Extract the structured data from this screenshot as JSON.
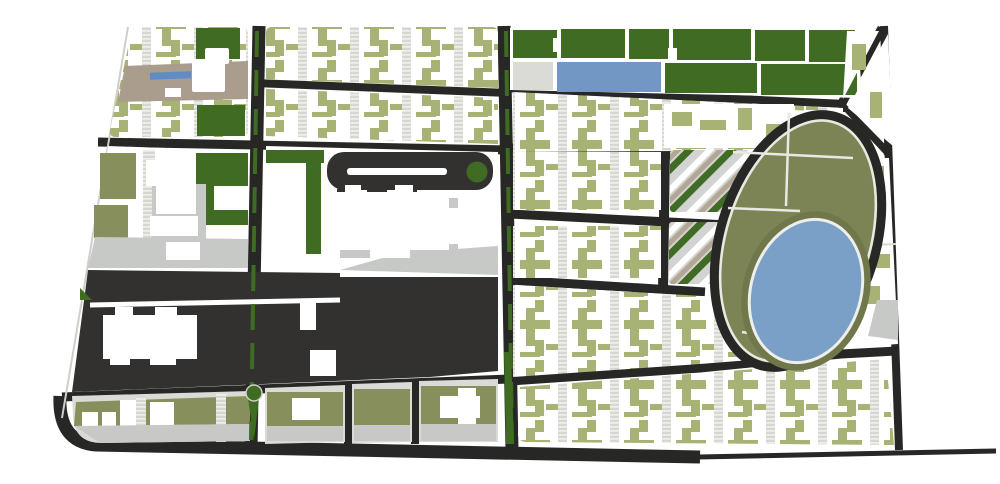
{
  "map": {
    "kind": "urban-masterplan-diagram",
    "background": "#ffffff",
    "colors": {
      "road": "#272725",
      "charcoal_block": "#323130",
      "dark_green": "#3f6b23",
      "olive_cross": "#a7b275",
      "olive_mid": "#87905c",
      "park_olive": "#7c8455",
      "lake_ring_olive": "#6f774b",
      "lake_blue": "#7ba0c8",
      "pool_blue": "#7297c4",
      "canal_blue": "#5f8cc4",
      "tan_band": "#aa9d8d",
      "light_gray": "#dadad6",
      "mid_gray": "#c7c9c6",
      "hatch_gray": "#d7d7d2",
      "hatch_tick": "#f4f4f1",
      "diag_gray": "#d2d4d1",
      "diag_tan": "#b4a694",
      "diag_green": "#3f6b25",
      "white": "#ffffff",
      "edge_gray": "#cfcfca",
      "sector_line": "#e9e9e4"
    },
    "features": [
      {
        "id": "north-avenue-grid",
        "desc": "white blocks with olive cross-shaped building clusters and hatched paths"
      },
      {
        "id": "heritage-band",
        "desc": "tan strip with canal and white landmark building, top-left"
      },
      {
        "id": "green-band",
        "desc": "row of dark green parcels with rectangular pool, top-center"
      },
      {
        "id": "campus-block",
        "desc": "white institutional buildings on gray plaza, left-center"
      },
      {
        "id": "dark-cbd-block",
        "desc": "large charcoal superblock with white landmark buildings"
      },
      {
        "id": "civic-bar",
        "desc": "charcoal bar building with white slot and green circular court"
      },
      {
        "id": "oval-park",
        "desc": "tilted elliptical park with ring road, olive sectors and blue lake, right"
      },
      {
        "id": "terraced-housing",
        "desc": "diagonal striped housing blocks west of oval park"
      },
      {
        "id": "south-wedge",
        "desc": "wedge shaped residential block along bottom road"
      },
      {
        "id": "avenue-west",
        "desc": "north-south avenue with green median and roundabout"
      },
      {
        "id": "avenue-east",
        "desc": "north-south avenue with green median"
      }
    ]
  }
}
